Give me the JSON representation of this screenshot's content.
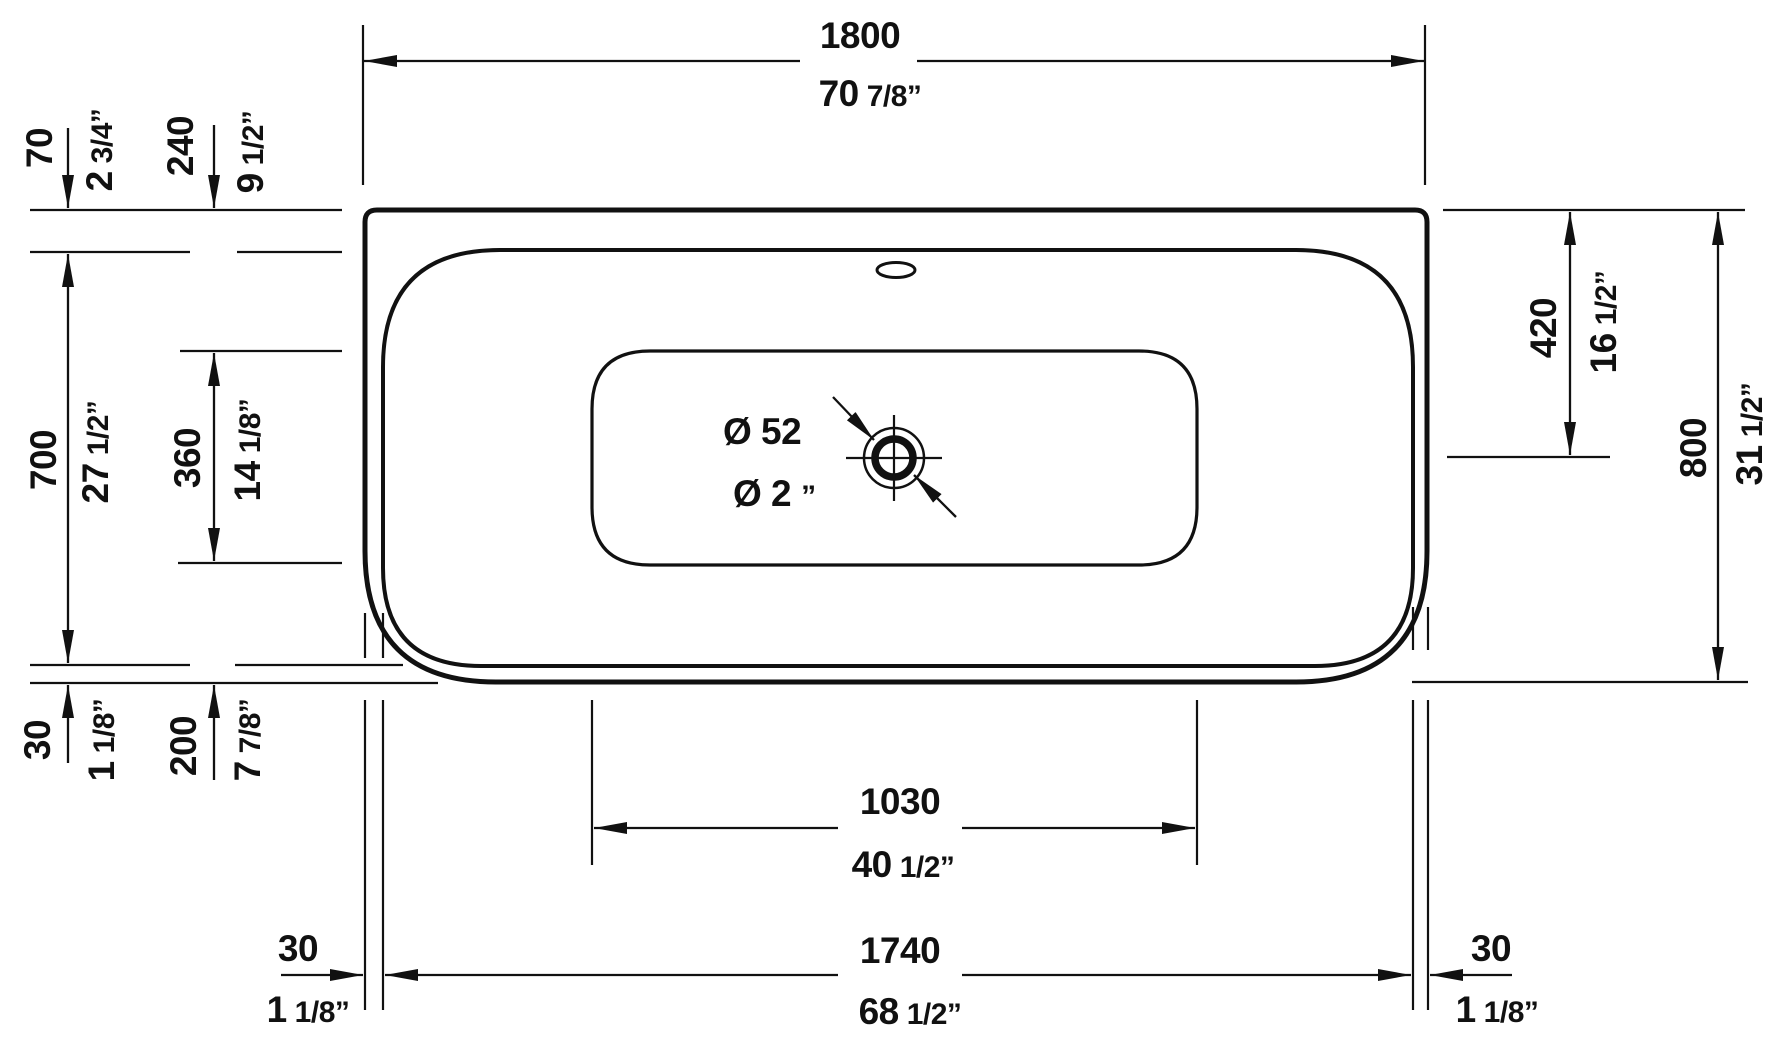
{
  "drawing": {
    "type": "bathtub-top-view-dimension-drawing",
    "units": [
      "mm",
      "inch"
    ]
  },
  "colors": {
    "line": "#111111",
    "background": "#ffffff"
  },
  "labels": {
    "overall_width": {
      "mm": "1800",
      "in_main": "70",
      "in_frac": "7/8”"
    },
    "rim_gap_top": {
      "mm": "70",
      "in_main": "2",
      "in_frac": "3/4”"
    },
    "well_gap_top": {
      "mm": "240",
      "in_main": "9",
      "in_frac": "1/2”"
    },
    "rim_depth": {
      "mm": "700",
      "in_main": "27",
      "in_frac": "1/2”"
    },
    "well_depth": {
      "mm": "360",
      "in_main": "14",
      "in_frac": "1/8”"
    },
    "rim_gap_bottom": {
      "mm": "30",
      "in_main": "1",
      "in_frac": "1/8”"
    },
    "well_gap_bottom": {
      "mm": "200",
      "in_main": "7",
      "in_frac": "7/8”"
    },
    "drain_offset": {
      "mm": "420",
      "in_main": "16",
      "in_frac": "1/2”"
    },
    "overall_depth": {
      "mm": "800",
      "in_main": "31",
      "in_frac": "1/2”"
    },
    "well_width": {
      "mm": "1030",
      "in_main": "40",
      "in_frac": "1/2”"
    },
    "rim_width": {
      "mm": "1740",
      "in_main": "68",
      "in_frac": "1/2”"
    },
    "rim_gap_left": {
      "mm": "30",
      "in_main": "1",
      "in_frac": "1/8”"
    },
    "rim_gap_right": {
      "mm": "30",
      "in_main": "1",
      "in_frac": "1/8”"
    },
    "drain_diameter": {
      "mm": "Ø 52",
      "in_main": "Ø 2",
      "in_frac": "”"
    }
  }
}
